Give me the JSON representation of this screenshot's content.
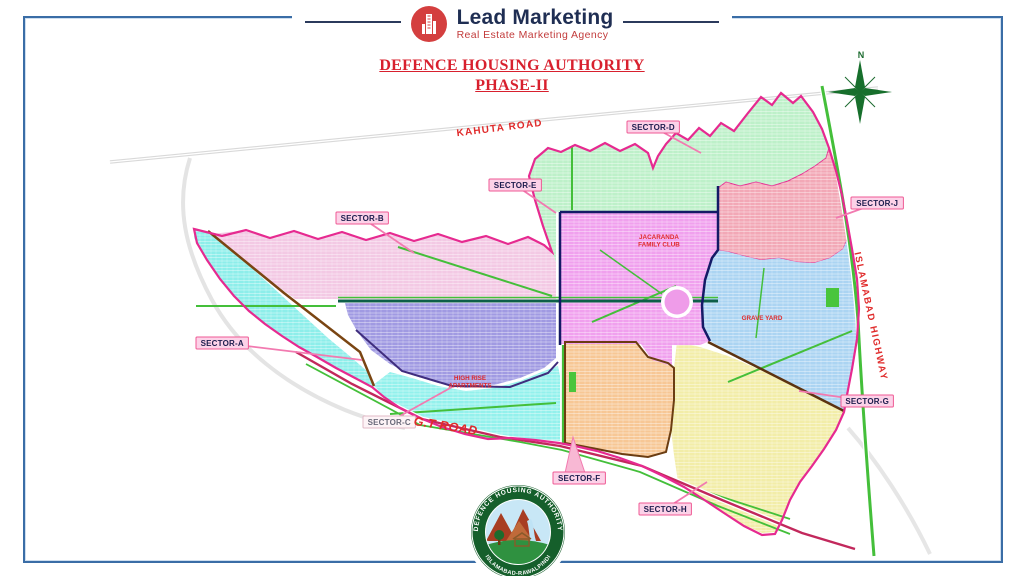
{
  "header": {
    "brand": "Lead Marketing",
    "tagline": "Real Estate Marketing Agency"
  },
  "title": {
    "line1": "DEFENCE HOUSING AUTHORITY",
    "line2": "PHASE-II"
  },
  "compass_label": "N",
  "icons": {
    "brand_logo": "building-tower-icon",
    "compass": "compass-rose-icon"
  },
  "map": {
    "sector_labels": [
      {
        "id": "sector-a",
        "label": "SECTOR-A",
        "x": 196,
        "y": 337,
        "tx": 362,
        "ty": 360
      },
      {
        "id": "sector-b",
        "label": "SECTOR-B",
        "x": 336,
        "y": 212,
        "tx": 414,
        "ty": 253
      },
      {
        "id": "sector-c",
        "label": "SECTOR-C",
        "x": 363,
        "y": 416,
        "tx": 452,
        "ty": 387,
        "muted": true
      },
      {
        "id": "sector-d",
        "label": "SECTOR-D",
        "x": 627,
        "y": 121,
        "tx": 701,
        "ty": 153
      },
      {
        "id": "sector-e",
        "label": "SECTOR-E",
        "x": 489,
        "y": 179,
        "tx": 556,
        "ty": 213
      },
      {
        "id": "sector-f",
        "label": "SECTOR-F",
        "x": 553,
        "y": 472,
        "tx": 573,
        "ty": 437,
        "wedge": true
      },
      {
        "id": "sector-g",
        "label": "SECTOR-G",
        "x": 841,
        "y": 395,
        "tx": 799,
        "ty": 391
      },
      {
        "id": "sector-h",
        "label": "SECTOR-H",
        "x": 639,
        "y": 503,
        "tx": 707,
        "ty": 482
      },
      {
        "id": "sector-j",
        "label": "SECTOR-J",
        "x": 851,
        "y": 197,
        "tx": 836,
        "ty": 218
      }
    ],
    "road_labels": [
      {
        "id": "kahuta-road",
        "label": "KAHUTA ROAD",
        "x": 500,
        "y": 131,
        "rotate": -7,
        "size": 10,
        "spacing": 1.2,
        "italic": false
      },
      {
        "id": "gt-road",
        "label": "G.T ROAD",
        "x": 445,
        "y": 430,
        "rotate": 9,
        "size": 12.5,
        "spacing": 0.4,
        "italic": true
      },
      {
        "id": "islamabad-highway",
        "label": "ISLAMABAD HIGHWAY",
        "x": 868,
        "y": 317,
        "rotate": 78,
        "size": 9.5,
        "spacing": 1.6,
        "italic": false
      }
    ],
    "place_labels": [
      {
        "id": "jacaranda-family-club",
        "lines": [
          "JACARANDA",
          "FAMILY CLUB"
        ],
        "x": 659,
        "y": 239
      },
      {
        "id": "grave-yard",
        "lines": [
          "GRAVE YARD"
        ],
        "x": 762,
        "y": 320
      },
      {
        "id": "high-rise-apartments",
        "lines": [
          "HIGH RISE",
          "APARTMENTS"
        ],
        "x": 470,
        "y": 380
      }
    ],
    "colors": {
      "sector_a": "#8deeea",
      "sector_b": "#f3c9e4",
      "sector_purple": "#a09ae2",
      "sector_e": "#bdf0c9",
      "sector_d": "#bdf0c9",
      "sector_j": "#f2a8b6",
      "sector_blue": "#abd4f2",
      "sector_yellow": "#f2eda8",
      "sector_orange": "#f7c795",
      "sector_highrise": "#93f1ec",
      "jacaranda": "#f0a0ee",
      "boundary": "#e62a90",
      "label_bg": "#fcd2e8",
      "label_border": "#ef5a94",
      "label_text": "#1d1d4e",
      "road_red": "#e02b2b",
      "green_road": "#44bf3a"
    }
  },
  "badge": {
    "arc_top": "DEFENCE HOUSING AUTHORITY",
    "arc_bottom": "ISLAMABAD-RAWALPINDI"
  }
}
